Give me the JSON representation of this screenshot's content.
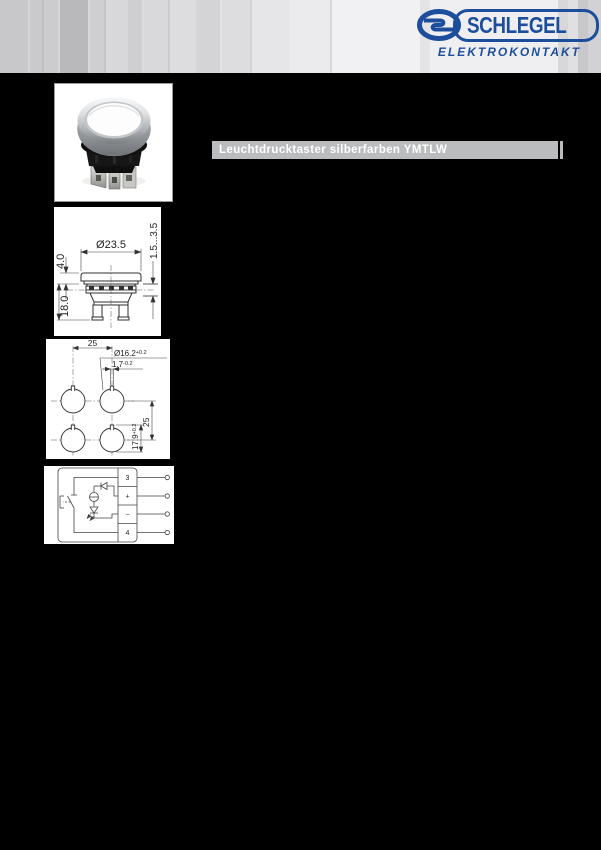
{
  "header": {
    "logo": {
      "brand": "SCHLEGEL",
      "registered": "®",
      "subline": "ELEKTROKONTAKT",
      "brand_color": "#1c4e9c"
    }
  },
  "title_bar": {
    "text": "Leuchtdrucktaster silberfarben YMTLW",
    "bg_color": "#bbbcbe"
  },
  "dimension_drawing": {
    "diameter": "Ø23.5",
    "cap_height": "4.0",
    "depth": "18.0",
    "panel_thickness": "1.5...3.5"
  },
  "drill_template": {
    "hole_spacing_horizontal": "25",
    "hole_spacing_vertical": "25",
    "hole_diameter": "Ø16.2",
    "hole_diameter_tolerance": "+0.2",
    "notch_width": "1.7",
    "notch_width_tolerance": "-0.2",
    "hole_height": "17.9",
    "hole_height_tolerance": "+0.2"
  },
  "circuit_diagram": {
    "terminals": [
      "3",
      "+",
      "−",
      "4"
    ]
  }
}
